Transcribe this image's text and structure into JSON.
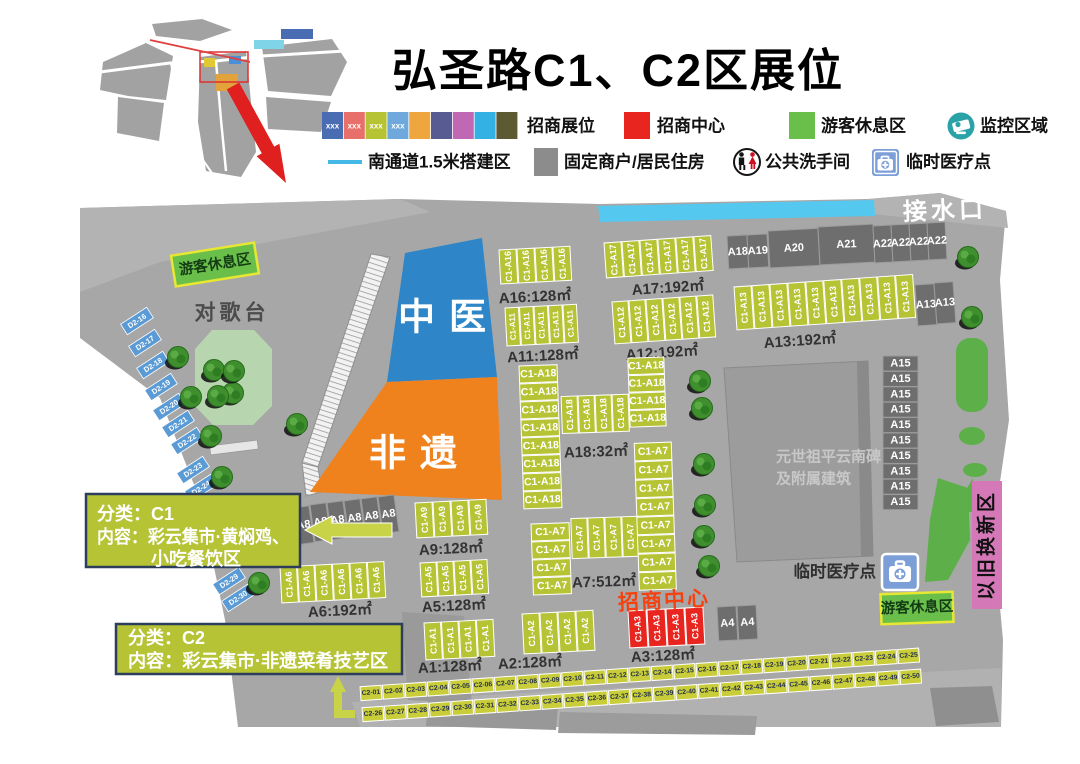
{
  "title": "弘圣路C1、C2区展位",
  "legend": {
    "swatch_text": "xxx",
    "swatch_colors": [
      "#4a6cb3",
      "#e8706a",
      "#b5c334",
      "#6fa8dc",
      "#f0a63e",
      "#585a92",
      "#c168b5",
      "#33b1e4",
      "#5d5a33"
    ],
    "booth_label": "招商展位",
    "center_label": "招商中心",
    "center_color": "#e8251f",
    "rest_label": "游客休息区",
    "rest_color": "#6abf4b",
    "monitor_label": "监控区域",
    "south_label": "南通道1.5米搭建区",
    "south_color": "#45b8e8",
    "fixed_label": "固定商户/居民住房",
    "fixed_color": "#8c8c8c",
    "toilet_label": "公共洗手间",
    "medical_label": "临时医疗点",
    "medical_color": "#7b9fd6"
  },
  "map": {
    "bg_color": "#a7a7a7",
    "booth_color": "#b5c334",
    "red_color": "#e8251f",
    "d2_color": "#5b9bd5",
    "c2_color": "#c9cd3a",
    "water_point": "接水口",
    "stage": "对歌台",
    "rest_area_top": "游客休息区",
    "rest_area_bottom": "游客休息区",
    "tcm": "中医",
    "heritage": "非遗",
    "monument_line1": "元世祖平云南碑",
    "monument_line2": "及附属建筑",
    "medical_point": "临时医疗点",
    "trade_in": "以旧换新区",
    "merchant_center": "招商中心",
    "c1_note_line1": "分类：C1",
    "c1_note_line2": "内容：彩云集市·黄焖鸡、",
    "c1_note_line3": "小吃餐饮区",
    "c2_note_line1": "分类：C2",
    "c2_note_line2": "内容：彩云集市·非遗菜肴技艺区",
    "booth_groups": [
      {
        "name": "A16",
        "booth": "C1-A16",
        "fill": "#b5c334",
        "tilt": -3,
        "strips": [
          {
            "x": 499,
            "y": 250,
            "n": 4,
            "dx": 18,
            "dy": 0,
            "w": 17,
            "h": 34,
            "o": "v"
          }
        ],
        "area": "A16:128㎡",
        "lx": 535,
        "ly": 297
      },
      {
        "name": "A17",
        "booth": "C1-A17",
        "fill": "#b5c334",
        "tilt": -4,
        "strips": [
          {
            "x": 604,
            "y": 243,
            "n": 6,
            "dx": 18,
            "dy": 0,
            "w": 17,
            "h": 35,
            "o": "v"
          }
        ],
        "area": "A17:192㎡",
        "lx": 668,
        "ly": 288
      },
      {
        "name": "A11",
        "booth": "C1-A11",
        "fill": "#b5c334",
        "tilt": -3,
        "strips": [
          {
            "x": 505,
            "y": 308,
            "n": 5,
            "dx": 14.5,
            "dy": 0,
            "w": 13.5,
            "h": 38,
            "o": "v",
            "fs": 8
          }
        ],
        "area": "A11:128㎡",
        "lx": 543,
        "ly": 356
      },
      {
        "name": "A12",
        "booth": "C1-A12",
        "fill": "#b5c334",
        "tilt": -4,
        "strips": [
          {
            "x": 612,
            "y": 302,
            "n": 6,
            "dx": 17,
            "dy": 0,
            "w": 16,
            "h": 42,
            "o": "v"
          }
        ],
        "area": "A12:192㎡",
        "lx": 662,
        "ly": 353
      },
      {
        "name": "A13",
        "booth": "C1-A13",
        "fill": "#b5c334",
        "tilt": -4,
        "strips": [
          {
            "x": 734,
            "y": 287,
            "n": 10,
            "dx": 18,
            "dy": 0,
            "w": 17,
            "h": 43,
            "o": "v"
          }
        ],
        "area": "A13:192㎡",
        "lx": 800,
        "ly": 341
      },
      {
        "name": "A18",
        "booth": "C1-A18",
        "fill": "#b5c334",
        "tilt": -2,
        "strips": [
          {
            "x": 519,
            "y": 366,
            "n": 8,
            "dx": 0,
            "dy": 18,
            "w": 38,
            "h": 17,
            "o": "h"
          },
          {
            "x": 560,
            "y": 398,
            "n": 4,
            "dx": 17,
            "dy": 0,
            "w": 16,
            "h": 37,
            "o": "v"
          },
          {
            "x": 628,
            "y": 362,
            "n": 4,
            "dx": 0,
            "dy": 17.5,
            "w": 36,
            "h": 16.5,
            "o": "h"
          }
        ],
        "area": "A18:32㎡",
        "lx": 596,
        "ly": 452
      },
      {
        "name": "A7",
        "booth": "C1-A7",
        "fill": "#b5c334",
        "tilt": -2,
        "strips": [
          {
            "x": 531,
            "y": 524,
            "n": 4,
            "dx": 0,
            "dy": 18,
            "w": 38,
            "h": 17,
            "o": "h"
          },
          {
            "x": 571,
            "y": 520,
            "n": 4,
            "dx": 17,
            "dy": 0,
            "w": 16,
            "h": 40,
            "o": "v"
          },
          {
            "x": 637,
            "y": 447,
            "n": 8,
            "dx": 0,
            "dy": 18.5,
            "w": 37,
            "h": 17.5,
            "o": "h"
          }
        ],
        "area": "A7:512㎡",
        "lx": 604,
        "ly": 582
      },
      {
        "name": "A9",
        "booth": "C1-A9",
        "fill": "#b5c334",
        "tilt": -3,
        "strips": [
          {
            "x": 415,
            "y": 503,
            "n": 4,
            "dx": 18,
            "dy": 0,
            "w": 17,
            "h": 35,
            "o": "v"
          }
        ],
        "area": "A9:128㎡",
        "lx": 451,
        "ly": 549
      },
      {
        "name": "A5",
        "booth": "C1-A5",
        "fill": "#b5c334",
        "tilt": -3,
        "strips": [
          {
            "x": 420,
            "y": 563,
            "n": 4,
            "dx": 17,
            "dy": 0,
            "w": 16,
            "h": 34,
            "o": "v"
          }
        ],
        "area": "A5:128㎡",
        "lx": 454,
        "ly": 606
      },
      {
        "name": "A6",
        "booth": "C1-A6",
        "fill": "#b5c334",
        "tilt": -3,
        "strips": [
          {
            "x": 280,
            "y": 567,
            "n": 6,
            "dx": 17.5,
            "dy": 0,
            "w": 16.5,
            "h": 36,
            "o": "v"
          }
        ],
        "area": "A6:192㎡",
        "lx": 340,
        "ly": 611
      },
      {
        "name": "A1",
        "booth": "C1-A1",
        "fill": "#b5c334",
        "tilt": -3,
        "strips": [
          {
            "x": 424,
            "y": 623,
            "n": 4,
            "dx": 17.5,
            "dy": 0,
            "w": 16.5,
            "h": 37,
            "o": "v"
          }
        ],
        "area": "A1:128㎡",
        "lx": 450,
        "ly": 667
      },
      {
        "name": "A2",
        "booth": "C1-A2",
        "fill": "#b5c334",
        "tilt": -3,
        "strips": [
          {
            "x": 522,
            "y": 614,
            "n": 4,
            "dx": 18,
            "dy": 0,
            "w": 17,
            "h": 40,
            "o": "v"
          }
        ],
        "area": "A2:128㎡",
        "lx": 530,
        "ly": 663
      },
      {
        "name": "A3",
        "booth": "C1-A3",
        "fill": "#e8251f",
        "tilt": -3,
        "strips": [
          {
            "x": 628,
            "y": 611,
            "n": 4,
            "dx": 19,
            "dy": 0,
            "w": 18,
            "h": 37,
            "o": "v"
          }
        ],
        "area": "A3:128㎡",
        "lx": 663,
        "ly": 656
      }
    ],
    "gray_boxes": [
      {
        "l": "A18",
        "x": 727,
        "y": 236,
        "w": 20,
        "h": 33,
        "t": -3
      },
      {
        "l": "A19",
        "x": 747,
        "y": 235,
        "w": 20,
        "h": 33,
        "t": -3
      },
      {
        "l": "A20",
        "x": 768,
        "y": 231,
        "w": 50,
        "h": 37,
        "t": -3
      },
      {
        "l": "A21",
        "x": 818,
        "y": 227,
        "w": 55,
        "h": 38,
        "t": -3
      },
      {
        "l": "A22",
        "x": 873,
        "y": 226,
        "w": 18,
        "h": 37,
        "t": -3
      },
      {
        "l": "A22",
        "x": 891,
        "y": 225,
        "w": 18,
        "h": 37,
        "t": -3
      },
      {
        "l": "A22",
        "x": 909,
        "y": 224,
        "w": 18,
        "h": 37,
        "t": -3
      },
      {
        "l": "A22",
        "x": 927,
        "y": 223,
        "w": 18,
        "h": 37,
        "t": -3
      },
      {
        "l": "A13",
        "x": 915,
        "y": 285,
        "w": 19,
        "h": 41,
        "t": -4
      },
      {
        "l": "A13",
        "x": 934,
        "y": 283,
        "w": 19,
        "h": 41,
        "t": -4
      },
      {
        "l": "A4",
        "x": 717,
        "y": 607,
        "w": 19,
        "h": 34,
        "t": -3
      },
      {
        "l": "A4",
        "x": 737,
        "y": 606,
        "w": 19,
        "h": 34,
        "t": -3
      },
      {
        "l": "A8",
        "x": 293,
        "y": 508,
        "w": 16,
        "h": 37,
        "t": -8
      },
      {
        "l": "A8",
        "x": 310,
        "y": 505,
        "w": 16,
        "h": 37,
        "t": -8
      },
      {
        "l": "A8",
        "x": 327,
        "y": 503,
        "w": 16,
        "h": 37,
        "t": -8
      },
      {
        "l": "A8",
        "x": 344,
        "y": 501,
        "w": 16,
        "h": 37,
        "t": -8
      },
      {
        "l": "A8",
        "x": 361,
        "y": 499,
        "w": 16,
        "h": 37,
        "t": -8
      },
      {
        "l": "A8",
        "x": 378,
        "y": 497,
        "w": 16,
        "h": 37,
        "t": -8
      },
      {
        "l": "A15",
        "x": 883,
        "y": 356,
        "w": 35,
        "h": 15,
        "t": 0,
        "n": 10,
        "dy": 15.4
      }
    ],
    "d2_booths": [
      {
        "l": "D2-16",
        "x": 137,
        "y": 321
      },
      {
        "l": "D2-17",
        "x": 145,
        "y": 343
      },
      {
        "l": "D2-18",
        "x": 153,
        "y": 365
      },
      {
        "l": "D2-19",
        "x": 161,
        "y": 387
      },
      {
        "l": "D2-20",
        "x": 169,
        "y": 407
      },
      {
        "l": "D2-21",
        "x": 178,
        "y": 424
      },
      {
        "l": "D2-22",
        "x": 187,
        "y": 441
      },
      {
        "l": "D2-23",
        "x": 193,
        "y": 470
      },
      {
        "l": "D2-24",
        "x": 201,
        "y": 488
      },
      {
        "l": "D2-29",
        "x": 229,
        "y": 581
      },
      {
        "l": "D2-30",
        "x": 238,
        "y": 598
      }
    ],
    "c2_rows": [
      {
        "prefix": "C2-",
        "from": 1,
        "to": 25,
        "x": 371,
        "y": 693,
        "dx": 22.4,
        "dy": -1.55
      },
      {
        "prefix": "C2-",
        "from": 26,
        "to": 50,
        "x": 373,
        "y": 714,
        "dx": 22.4,
        "dy": -1.55
      }
    ],
    "trees": [
      [
        178,
        357
      ],
      [
        191,
        397
      ],
      [
        211,
        436
      ],
      [
        222,
        477
      ],
      [
        259,
        583
      ],
      [
        297,
        424
      ],
      [
        214,
        370
      ],
      [
        233,
        393
      ],
      [
        234,
        371
      ],
      [
        218,
        396
      ],
      [
        700,
        381
      ],
      [
        702,
        408
      ],
      [
        704,
        464
      ],
      [
        705,
        505
      ],
      [
        704,
        536
      ],
      [
        709,
        566
      ],
      [
        968,
        257
      ],
      [
        972,
        317
      ]
    ]
  }
}
